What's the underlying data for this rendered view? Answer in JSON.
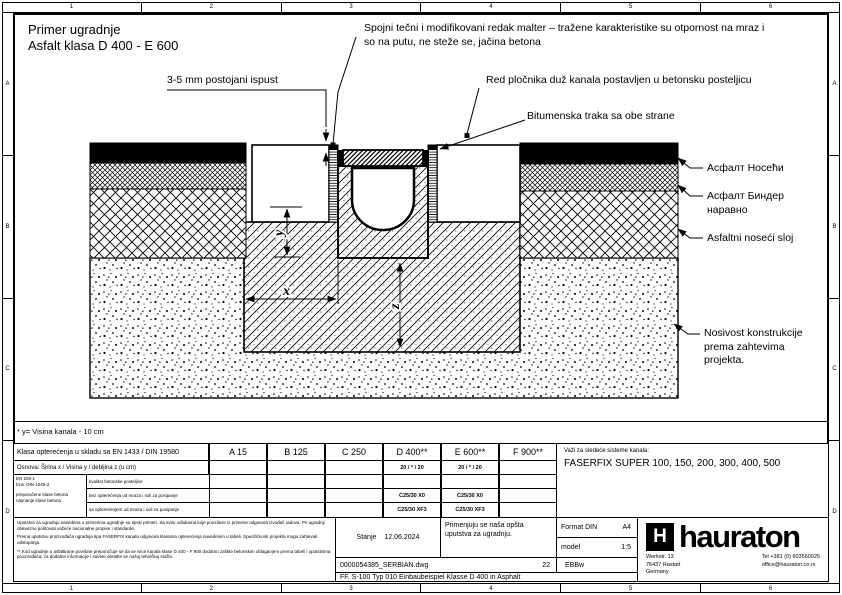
{
  "frame": {
    "cols": [
      "1",
      "2",
      "3",
      "4",
      "5",
      "6"
    ],
    "rows": [
      "A",
      "B",
      "C",
      "D"
    ]
  },
  "title": {
    "line1": "Primer ugradnje",
    "line2": "Asfalt klasa D 400 - E 600"
  },
  "ann": {
    "gap": "3-5 mm postojani ispust",
    "mortar1": "Spojni tečni i modifikovani redak malter – tražene karakteristike su otpornost na mraz i",
    "mortar2": "so na putu, ne steže se, jačina betona",
    "paving": "Red pločnika duž kanala postavljen u betonsku posteljicu",
    "bitumen": "Bitumenska traka sa obe strane",
    "asphalt_wear": "Асфалт Носећи",
    "asphalt_binder1": "Асфалт Биндер",
    "asphalt_binder2": "наравно",
    "asphalt_base": "Asfaltni noseći sloj",
    "bearing1": "Nosivost konstrukcije",
    "bearing2": "prema zahtevima",
    "bearing3": "projekta.",
    "dimx": "x",
    "dimy": "y",
    "dimz": "z",
    "footnote": "* y= Visina kanala - 10 cm"
  },
  "table": {
    "load_label": "Klasa opterećenja u skladu sa EN 1433 / DIN 19580",
    "classes": [
      "A 15",
      "B 125",
      "C 250",
      "D 400**",
      "E 600**",
      "F 900**"
    ],
    "found_label": "Osnova: Širina x / Visina y / debljina z (u cm)",
    "found_d": "20 / * / 20",
    "found_e": "20 / * / 20",
    "norm1": "EN 206-1",
    "norm2": "bzw. DIN 1045-2",
    "norm3": "preporučene klase betona",
    "norm4": "najmanje klase betona",
    "r1_label": "kvalitet betonske posteljice",
    "r2_label": "bez opterećenja od mraza i soli za posipanje",
    "r2_d": "C25/30 X0",
    "r2_e": "C25/30 X0",
    "r3_label": "sa opterećenjem od mraza i soli za posipanje",
    "r3_d": "C25/30 XF3",
    "r3_e": "C25/30 XF3",
    "valid_label": "Važi za sledeće sisteme kanala:",
    "valid_systems": "FASERFIX SUPER 100, 150, 200, 300, 400, 500"
  },
  "tb": {
    "p1": "Uputstva za ugradnju navedena u primerima ugradnje su tipski primeri. Sa svim odlukama koje proizilaze iz primene odgovara izvođač radova. Pri ugradnji obavezno poštovati važeće nacionalne propise i standarde.",
    "p2": "Prema uputstvu proizvođača ugradnja tipa FASERFIX kanala odgovara klasama opterećenja navedenim u tabeli. Specifičnosti projekta mogu zahtevati odstupanja.",
    "p3": "** Kod ugradnje u asfaltirane površine preporučuje se da se ivice kanala klase D 400 - F 900 dodatno zaštite betonskim oblaganjem prema tabeli i uputstvima proizvođača; za dodatne informacije i savete obratite se našoj tehničkoj službi.",
    "status_label": "Stanje",
    "status_date": "12.06.2024",
    "note1": "Primenjuju se naša opšta",
    "note2": "uputstva za ugradnju.",
    "format_label": "Format DIN",
    "format_value": "A4",
    "scale_label": "model",
    "scale_value": "1:5",
    "file": "0000054385_SERBIAN.dwg",
    "sheet": "22",
    "code": "EBBw",
    "dtitle": "FF. S-100 Typ 010 Einbaubeispiel Klasse D 400 in Asphalt",
    "brand_mark": "H",
    "brand": "hauraton",
    "addr1": "Werkstr. 13",
    "addr2": "76437 Rastatt",
    "addr3": "Germany",
    "tel": "Tel +381 (0) 603560025",
    "mail": "office@hauraton.co.rs"
  }
}
